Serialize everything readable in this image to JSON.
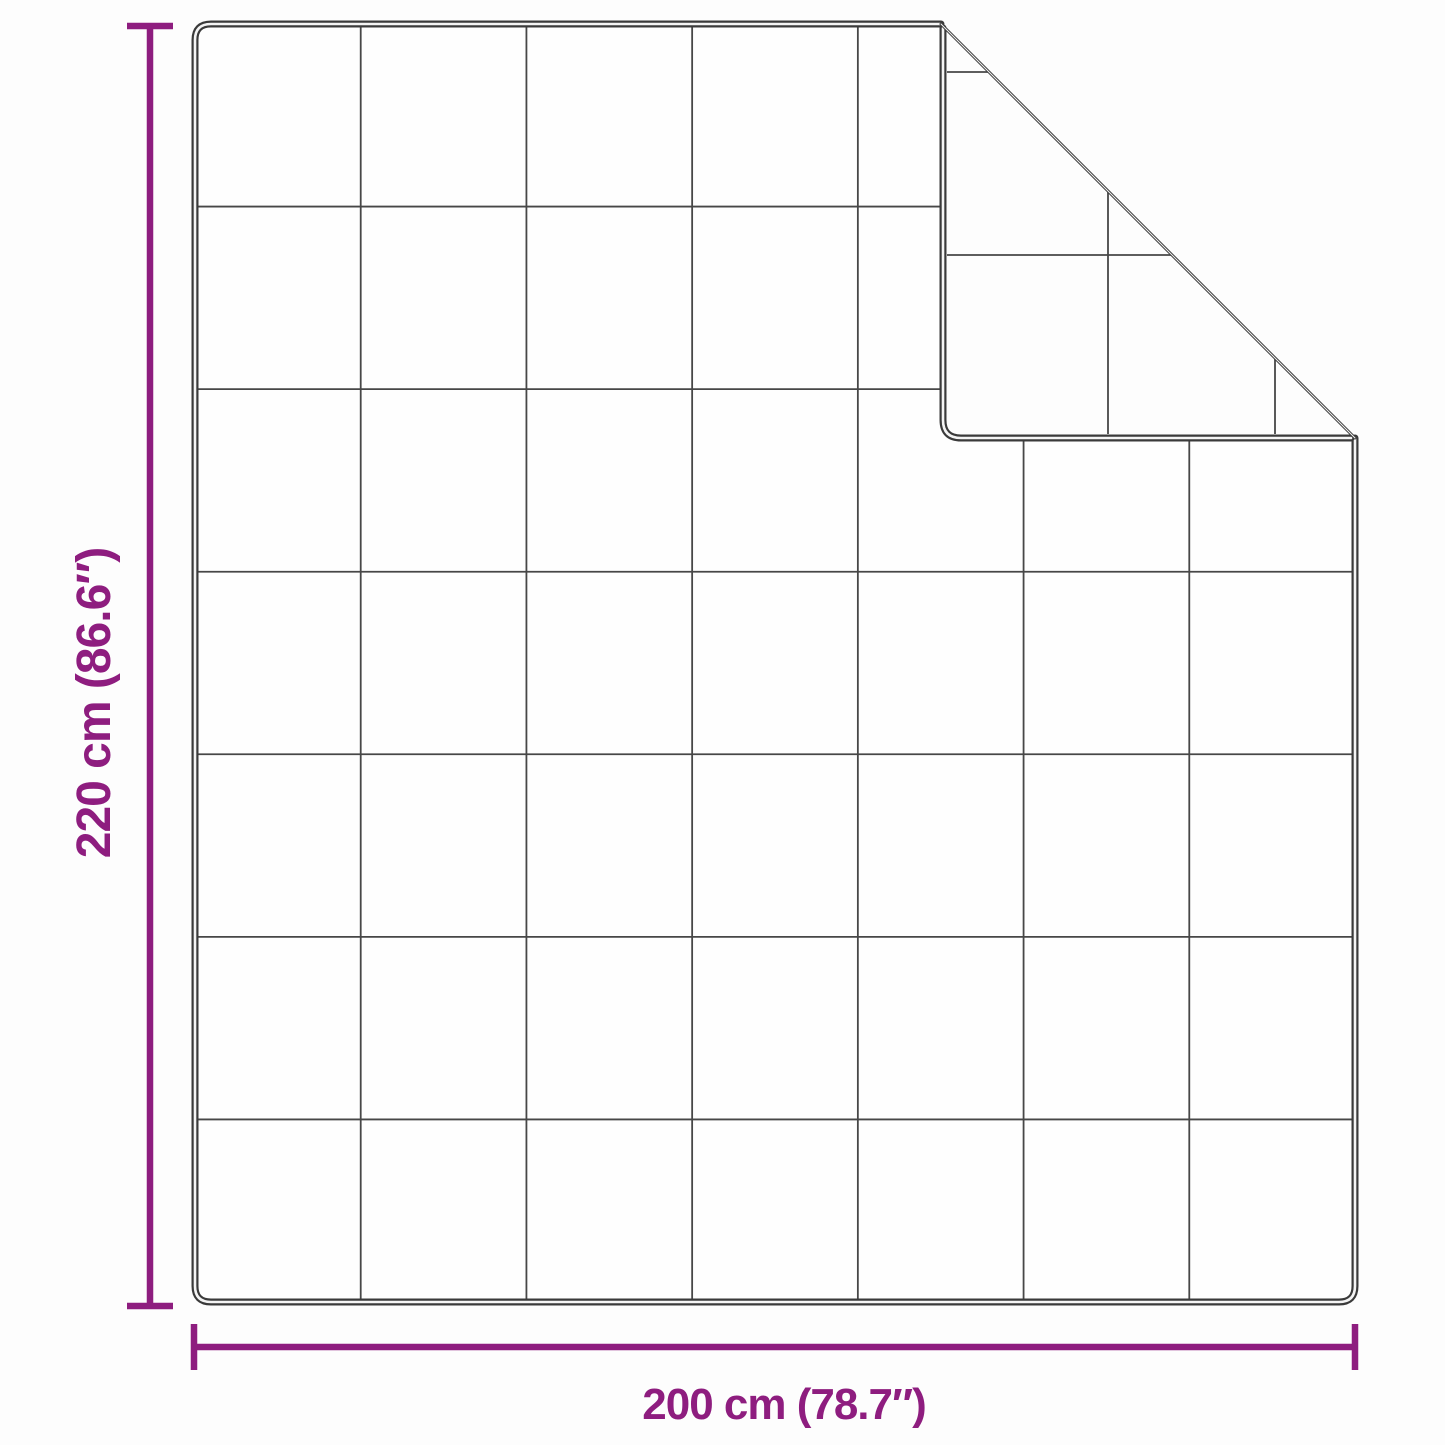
{
  "page": {
    "background": "#fdfdfd"
  },
  "diagram": {
    "kind": "blanket-dimension-diagram",
    "subject": "quilted blanket, top-right corner folded over",
    "colors": {
      "accent": "#8E1D7F",
      "outline": "#3a3a3a",
      "grid": "#474747"
    },
    "grid": {
      "columns": 7,
      "rows": 7
    },
    "height_dimension": {
      "label": "220 cm (86.6″)",
      "cm": 220,
      "inches": 86.6
    },
    "width_dimension": {
      "label": "200 cm (78.7″)",
      "cm": 200,
      "inches": 78.7
    }
  }
}
